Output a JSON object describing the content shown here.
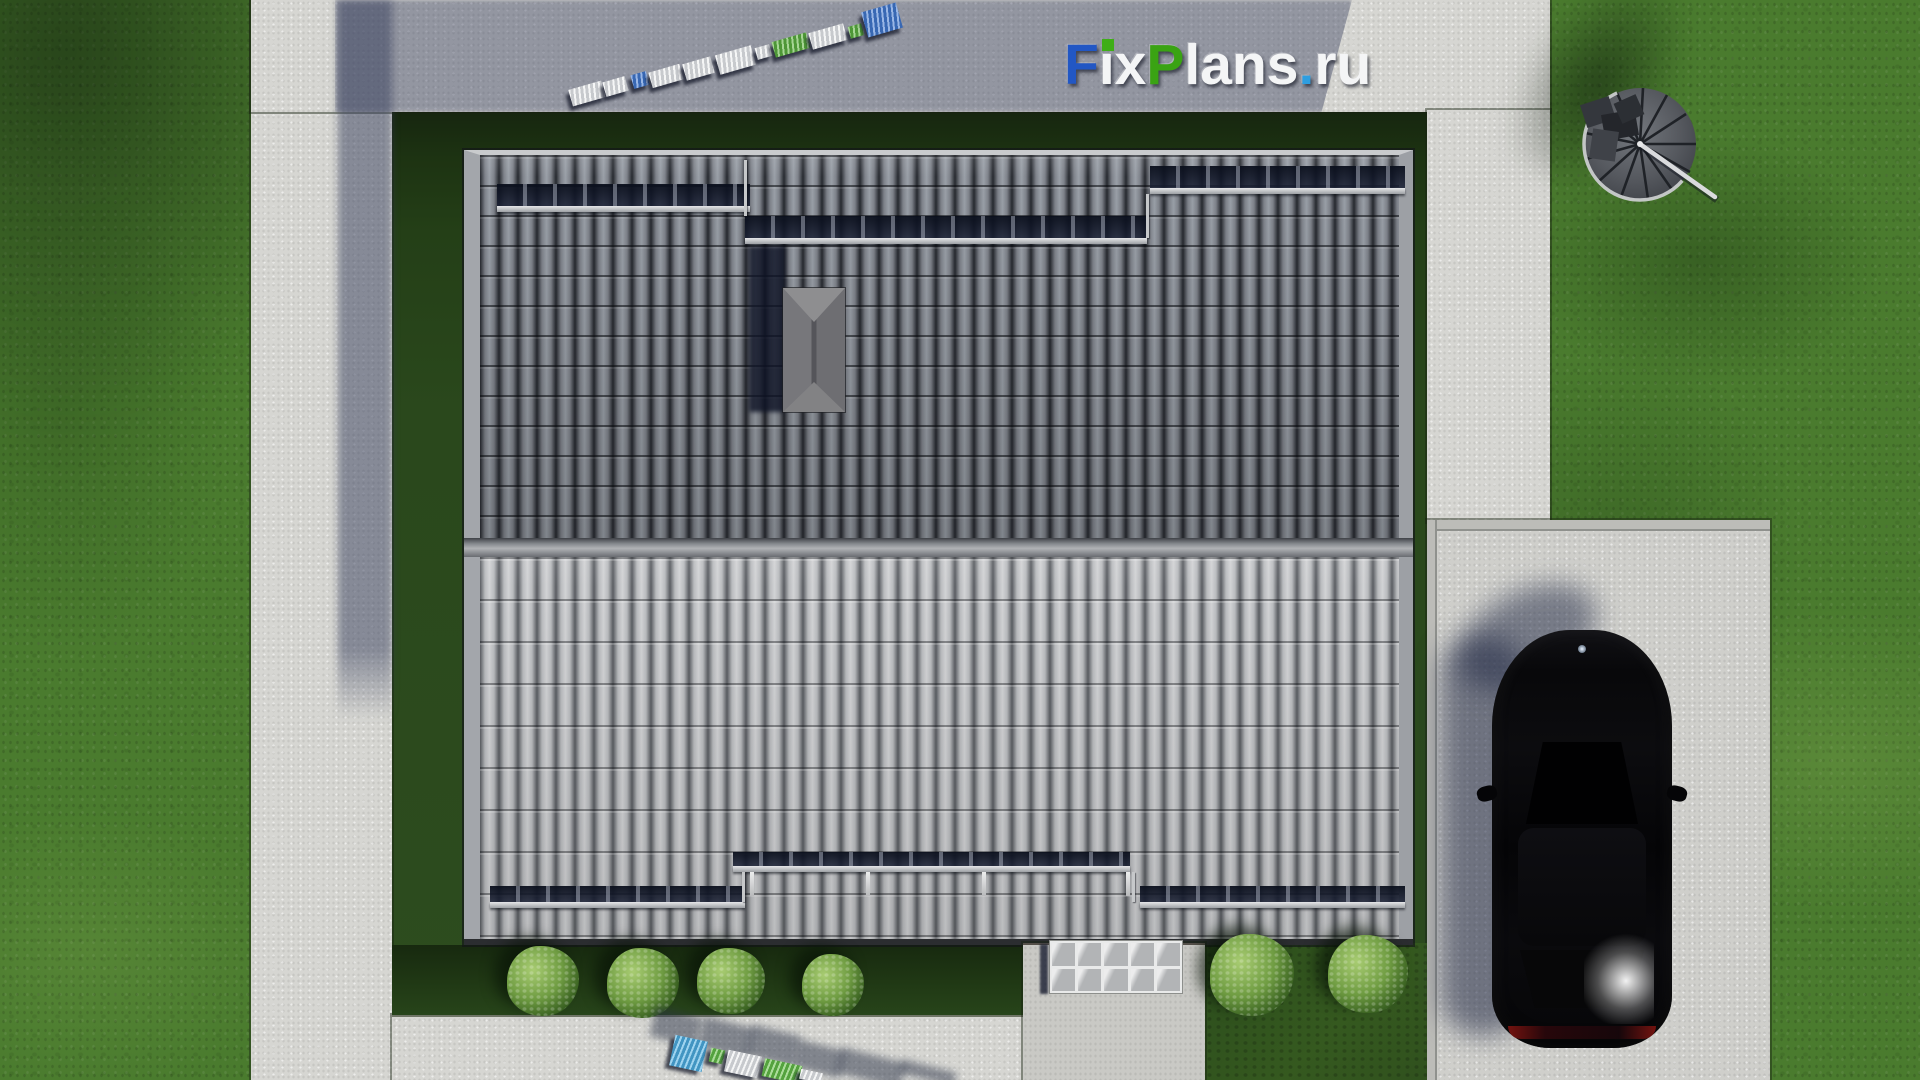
{
  "watermark": {
    "text": "FixPlans.ru",
    "letters": [
      {
        "ch": "F",
        "color": "#2257c4"
      },
      {
        "ch": "ı",
        "color": "#f4f5f6",
        "dot": "#3fae17"
      },
      {
        "ch": "x",
        "color": "#f4f5f6"
      },
      {
        "ch": "P",
        "color": "#3aa313"
      },
      {
        "ch": "l",
        "color": "#f4f5f6"
      },
      {
        "ch": "a",
        "color": "#f4f5f6"
      },
      {
        "ch": "n",
        "color": "#f4f5f6"
      },
      {
        "ch": "s",
        "color": "#f4f5f6"
      },
      {
        "ch": ".",
        "color": "#2e9ee0"
      },
      {
        "ch": "r",
        "color": "#f4f5f6"
      },
      {
        "ch": "u",
        "color": "#f4f5f6"
      }
    ]
  },
  "palette": {
    "lawn": "#4a7b2e",
    "yard_shadow_grass": "#243f17",
    "concrete": "#d6d6d2",
    "concrete_shadow": "#8f939e",
    "roof_upper": "#6a6d73",
    "roof_lower": "#b9bbbe",
    "logo_blue": "#2257c4",
    "logo_green": "#3aa313",
    "logo_azure": "#2e9ee0",
    "car_black": "#060608",
    "taillight_red": "#7d1410"
  },
  "canopy": {
    "rows": 2,
    "cols": 5
  },
  "boxes": [
    {
      "cls": "bar-band",
      "name": "snow-guard-band-top-left",
      "x": 497,
      "y": 184,
      "w": 253,
      "h": 22
    },
    {
      "cls": "bar-rail",
      "name": "snow-guard-rail-top-left",
      "x": 497,
      "y": 206,
      "w": 253,
      "h": 6
    },
    {
      "cls": "bar-band",
      "name": "snow-guard-band-top-middle",
      "x": 745,
      "y": 216,
      "w": 402,
      "h": 22
    },
    {
      "cls": "bar-rail",
      "name": "snow-guard-rail-top-middle",
      "x": 745,
      "y": 238,
      "w": 402,
      "h": 6
    },
    {
      "cls": "bar-band",
      "name": "snow-guard-band-top-right",
      "x": 1150,
      "y": 166,
      "w": 255,
      "h": 22
    },
    {
      "cls": "bar-rail",
      "name": "snow-guard-rail-top-right",
      "x": 1150,
      "y": 188,
      "w": 255,
      "h": 6
    },
    {
      "cls": "bar-conn",
      "name": "snow-guard-connector",
      "x": 744,
      "y": 160,
      "w": 3,
      "h": 56
    },
    {
      "cls": "bar-conn",
      "name": "snow-guard-connector",
      "x": 1146,
      "y": 194,
      "w": 3,
      "h": 44
    },
    {
      "cls": "bar-band",
      "name": "snow-guard-band-bottom-left",
      "x": 490,
      "y": 886,
      "w": 255,
      "h": 16
    },
    {
      "cls": "bar-rail",
      "name": "snow-guard-rail-bottom-left",
      "x": 490,
      "y": 902,
      "w": 255,
      "h": 6
    },
    {
      "cls": "bar-band",
      "name": "snow-guard-band-bottom-middle",
      "x": 733,
      "y": 852,
      "w": 397,
      "h": 14
    },
    {
      "cls": "bar-rail",
      "name": "snow-guard-rail-bottom-middle",
      "x": 733,
      "y": 866,
      "w": 397,
      "h": 6
    },
    {
      "cls": "bar-rod",
      "name": "gutter-rod",
      "x": 750,
      "y": 872,
      "w": 4,
      "h": 24
    },
    {
      "cls": "bar-rod",
      "name": "gutter-rod",
      "x": 866,
      "y": 872,
      "w": 4,
      "h": 24
    },
    {
      "cls": "bar-rod",
      "name": "gutter-rod",
      "x": 982,
      "y": 872,
      "w": 4,
      "h": 24
    },
    {
      "cls": "bar-rod",
      "name": "gutter-rod",
      "x": 1126,
      "y": 872,
      "w": 4,
      "h": 24
    },
    {
      "cls": "bar-conn",
      "name": "snow-guard-connector",
      "x": 742,
      "y": 872,
      "w": 3,
      "h": 30
    },
    {
      "cls": "bar-conn",
      "name": "snow-guard-connector",
      "x": 1132,
      "y": 872,
      "w": 3,
      "h": 30
    },
    {
      "cls": "bar-band",
      "name": "snow-guard-band-bottom-right",
      "x": 1140,
      "y": 886,
      "w": 265,
      "h": 16
    },
    {
      "cls": "bar-rail",
      "name": "snow-guard-rail-bottom-right",
      "x": 1140,
      "y": 902,
      "w": 265,
      "h": 6
    },
    {
      "cls": "bush",
      "name": "bush",
      "x": 507,
      "y": 946,
      "w": 72,
      "h": 70
    },
    {
      "cls": "bush",
      "name": "bush",
      "x": 607,
      "y": 948,
      "w": 72,
      "h": 70
    },
    {
      "cls": "bush",
      "name": "bush",
      "x": 697,
      "y": 948,
      "w": 68,
      "h": 66
    },
    {
      "cls": "bush",
      "name": "bush",
      "x": 802,
      "y": 954,
      "w": 62,
      "h": 62
    },
    {
      "cls": "bush",
      "name": "bush",
      "x": 1210,
      "y": 934,
      "w": 84,
      "h": 82
    },
    {
      "cls": "bush",
      "name": "bush",
      "x": 1328,
      "y": 935,
      "w": 80,
      "h": 78
    },
    {
      "cls": "block3d",
      "name": "logo3d-top-block",
      "x": 570,
      "y": 85,
      "w": 34,
      "h": 17,
      "rot": -16,
      "c": "#e9eaeb"
    },
    {
      "cls": "block3d",
      "name": "logo3d-top-block",
      "x": 604,
      "y": 79,
      "w": 23,
      "h": 15,
      "rot": -16,
      "c": "#e9eaeb"
    },
    {
      "cls": "block3d",
      "name": "logo3d-top-block",
      "x": 632,
      "y": 73,
      "w": 16,
      "h": 14,
      "rot": -16,
      "c": "#1c5ec6"
    },
    {
      "cls": "block3d",
      "name": "logo3d-top-block",
      "x": 650,
      "y": 68,
      "w": 32,
      "h": 16,
      "rot": -16,
      "c": "#e9eaeb"
    },
    {
      "cls": "block3d",
      "name": "logo3d-top-block",
      "x": 684,
      "y": 60,
      "w": 29,
      "h": 17,
      "rot": -16,
      "c": "#e9eaeb"
    },
    {
      "cls": "block3d",
      "name": "logo3d-top-block",
      "x": 717,
      "y": 50,
      "w": 37,
      "h": 20,
      "rot": -16,
      "c": "#e9eaeb"
    },
    {
      "cls": "block3d",
      "name": "logo3d-top-block",
      "x": 756,
      "y": 46,
      "w": 15,
      "h": 12,
      "rot": -16,
      "c": "#e9eaeb"
    },
    {
      "cls": "block3d",
      "name": "logo3d-top-block",
      "x": 773,
      "y": 37,
      "w": 36,
      "h": 16,
      "rot": -16,
      "c": "#3ba214"
    },
    {
      "cls": "block3d",
      "name": "logo3d-top-block",
      "x": 810,
      "y": 28,
      "w": 36,
      "h": 17,
      "rot": -16,
      "c": "#e9eaeb"
    },
    {
      "cls": "block3d",
      "name": "logo3d-top-block",
      "x": 849,
      "y": 25,
      "w": 14,
      "h": 12,
      "rot": -16,
      "c": "#3ba214"
    },
    {
      "cls": "block3d",
      "name": "logo3d-top-block",
      "x": 864,
      "y": 7,
      "w": 36,
      "h": 26,
      "rot": -16,
      "c": "#1c5ec6"
    },
    {
      "cls": "block3d-shadow",
      "name": "logo3d-bottom-shadow",
      "x": 652,
      "y": 1012,
      "w": 48,
      "h": 30,
      "rot": 14
    },
    {
      "cls": "block3d-shadow",
      "name": "logo3d-bottom-shadow",
      "x": 700,
      "y": 1022,
      "w": 52,
      "h": 32,
      "rot": 14
    },
    {
      "cls": "block3d-shadow",
      "name": "logo3d-bottom-shadow",
      "x": 748,
      "y": 1030,
      "w": 50,
      "h": 32,
      "rot": 14
    },
    {
      "cls": "block3d-shadow",
      "name": "logo3d-bottom-shadow",
      "x": 795,
      "y": 1045,
      "w": 48,
      "h": 28,
      "rot": 14
    },
    {
      "cls": "block3d-shadow",
      "name": "logo3d-bottom-shadow",
      "x": 838,
      "y": 1055,
      "w": 66,
      "h": 26,
      "rot": 14
    },
    {
      "cls": "block3d-shadow",
      "name": "logo3d-bottom-shadow",
      "x": 900,
      "y": 1066,
      "w": 56,
      "h": 14,
      "rot": 14
    },
    {
      "cls": "block3d",
      "name": "logo3d-bottom-block",
      "x": 672,
      "y": 1038,
      "w": 33,
      "h": 31,
      "rot": 12,
      "c": "#2b9fdb"
    },
    {
      "cls": "block3d",
      "name": "logo3d-bottom-block",
      "x": 710,
      "y": 1049,
      "w": 14,
      "h": 14,
      "rot": 12,
      "c": "#44b11e"
    },
    {
      "cls": "block3d",
      "name": "logo3d-bottom-block",
      "x": 726,
      "y": 1053,
      "w": 34,
      "h": 22,
      "rot": 12,
      "c": "#e9eaeb"
    },
    {
      "cls": "block3d",
      "name": "logo3d-bottom-block",
      "x": 763,
      "y": 1062,
      "w": 38,
      "h": 18,
      "rot": 12,
      "c": "#44b11e"
    },
    {
      "cls": "block3d",
      "name": "logo3d-bottom-block",
      "x": 800,
      "y": 1071,
      "w": 22,
      "h": 10,
      "rot": 12,
      "c": "#e9eaeb"
    }
  ]
}
